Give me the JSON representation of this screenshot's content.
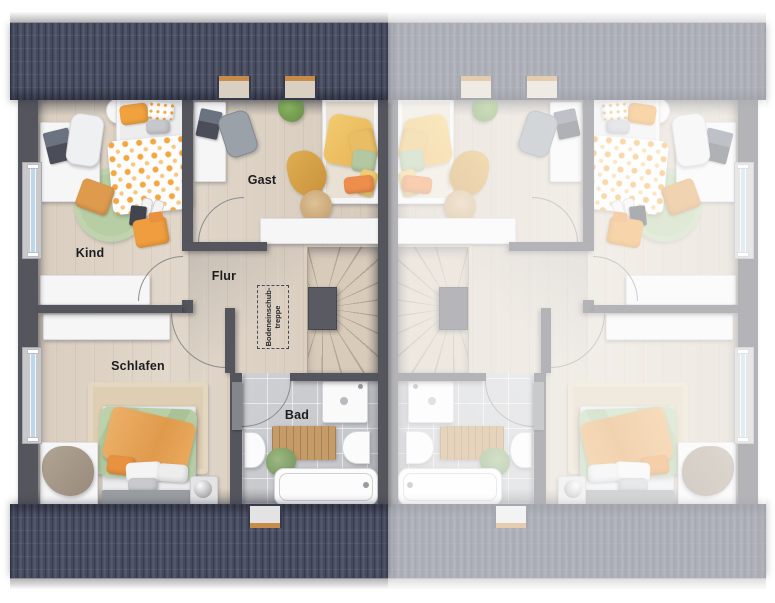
{
  "floorplan": {
    "rooms": [
      {
        "id": "kind",
        "label": "Kind"
      },
      {
        "id": "gast",
        "label": "Gast"
      },
      {
        "id": "flur",
        "label": "Flur"
      },
      {
        "id": "schlafen",
        "label": "Schlafen"
      },
      {
        "id": "bad",
        "label": "Bad"
      }
    ],
    "attic_hatch": {
      "line1": "Bodeneinschub-",
      "line2": "treppe"
    },
    "units": [
      {
        "id": "unit-left",
        "rendering": "full color"
      },
      {
        "id": "unit-right",
        "rendering": "mirrored duplicate, faded"
      }
    ],
    "colors": {
      "roof": "#474b5e",
      "gutter": "#d4d4d6",
      "wall": "#54555d",
      "wood_floor": "#dbd0c2",
      "tile_floor": "#c9cacd",
      "stair_tread": "#d8cbba",
      "rug_green": "#b7cda3",
      "duvet_green": "#b2c9a1",
      "accent_orange": "#efa13e",
      "window_glass": "#bcd7e9",
      "fade_overlay": "rgba(255,255,255,0.56)"
    }
  }
}
